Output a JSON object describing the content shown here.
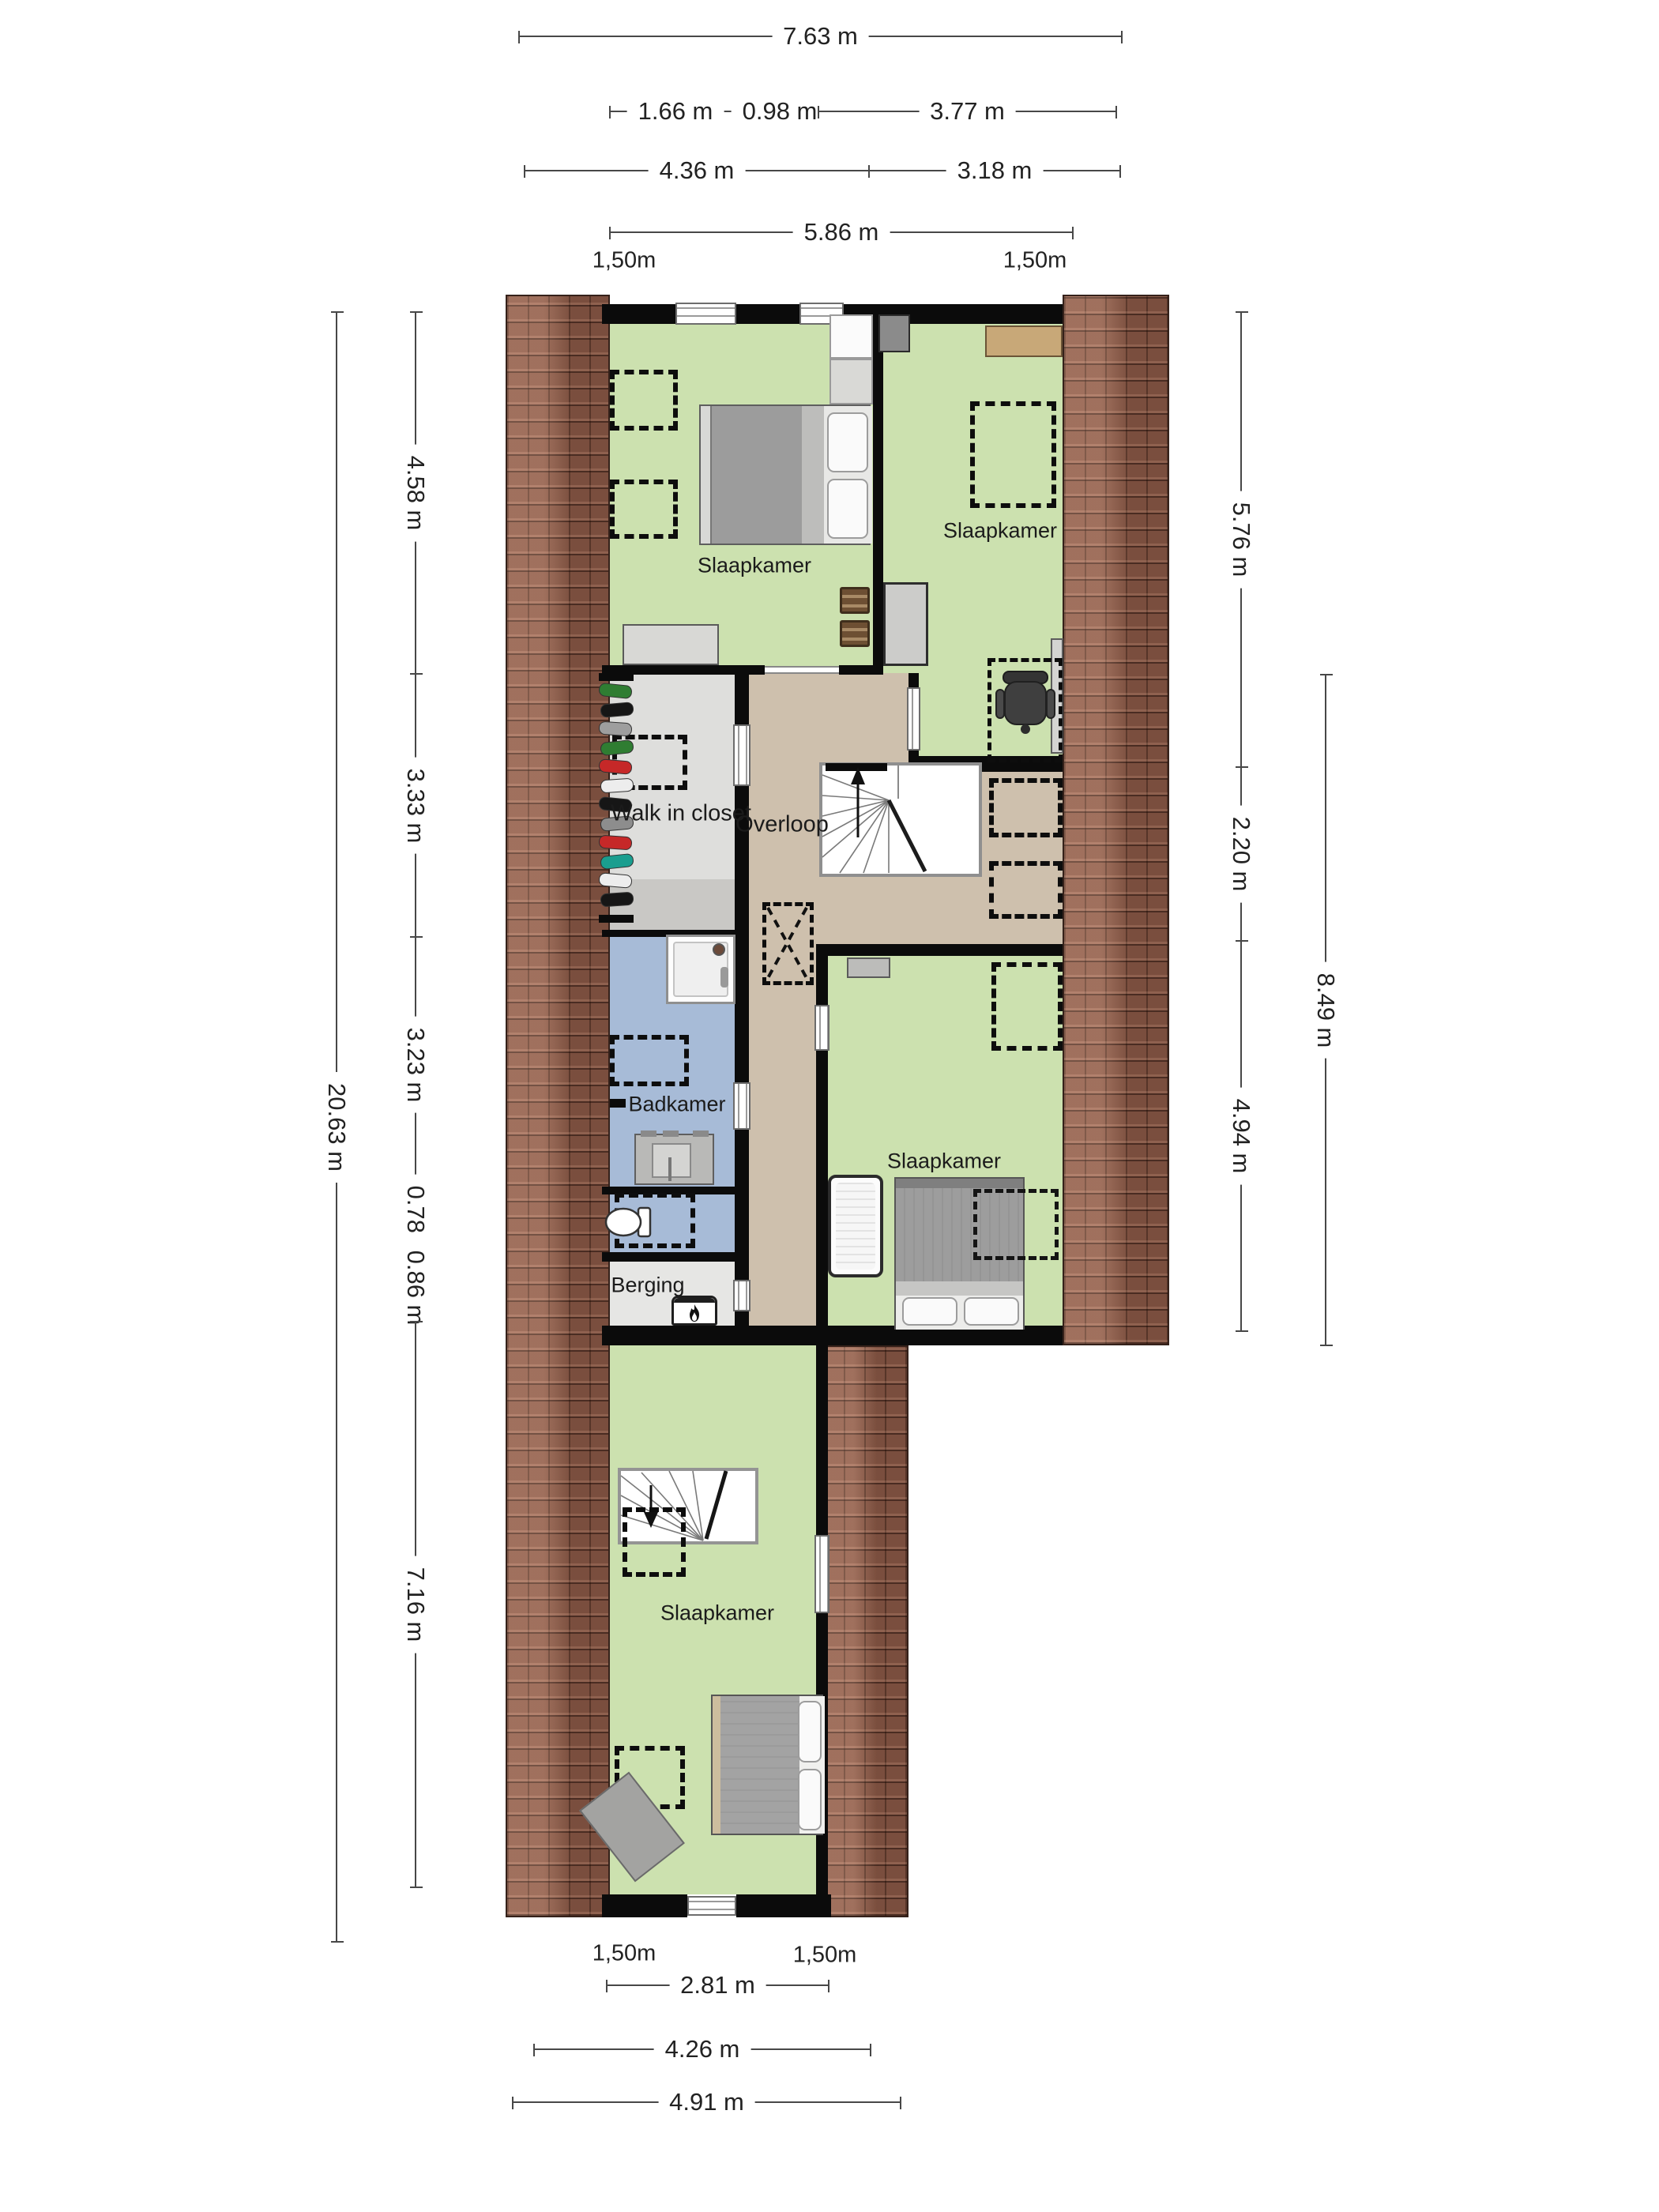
{
  "title": "Floor plan - second floor (attic)",
  "rooms": {
    "bedroom_top_left": "Slaapkamer",
    "bedroom_top_right": "Slaapkamer",
    "bedroom_middle": "Slaapkamer",
    "bedroom_attic": "Slaapkamer",
    "closet": "Walk in closet",
    "landing": "Overloop",
    "bathroom": "Badkamer",
    "storage": "Berging"
  },
  "dimensions": {
    "total_width": "7.63 m",
    "seg166": "1.66 m",
    "seg098": "0.98 m",
    "seg377": "3.77 m",
    "seg436": "4.36 m",
    "seg318": "3.18 m",
    "seg586": "5.86 m",
    "eave_top_left": "1,50m",
    "eave_top_right": "1,50m",
    "total_height": "20.63 m",
    "seg458": "4.58 m",
    "seg333": "3.33 m",
    "seg323": "3.23 m",
    "seg078": "0.78 m",
    "seg086": "0.86 m",
    "seg716": "7.16 m",
    "seg576": "5.76 m",
    "seg220": "2.20 m",
    "seg494": "4.94 m",
    "seg849": "8.49 m",
    "eave_bottom_left": "1,50m",
    "eave_bottom_right": "1,50m",
    "seg281": "2.81 m",
    "seg426": "4.26 m",
    "seg491": "4.91 m"
  },
  "colors": {
    "floor_bedroom": "#cce1af",
    "floor_landing": "#cec0ad",
    "floor_bathroom": "#a7bbd7",
    "floor_closet": "#dededc",
    "floor_storage": "#e6e6e4",
    "roof_tiles": "#8a5947",
    "wall": "#0b0b0b"
  }
}
